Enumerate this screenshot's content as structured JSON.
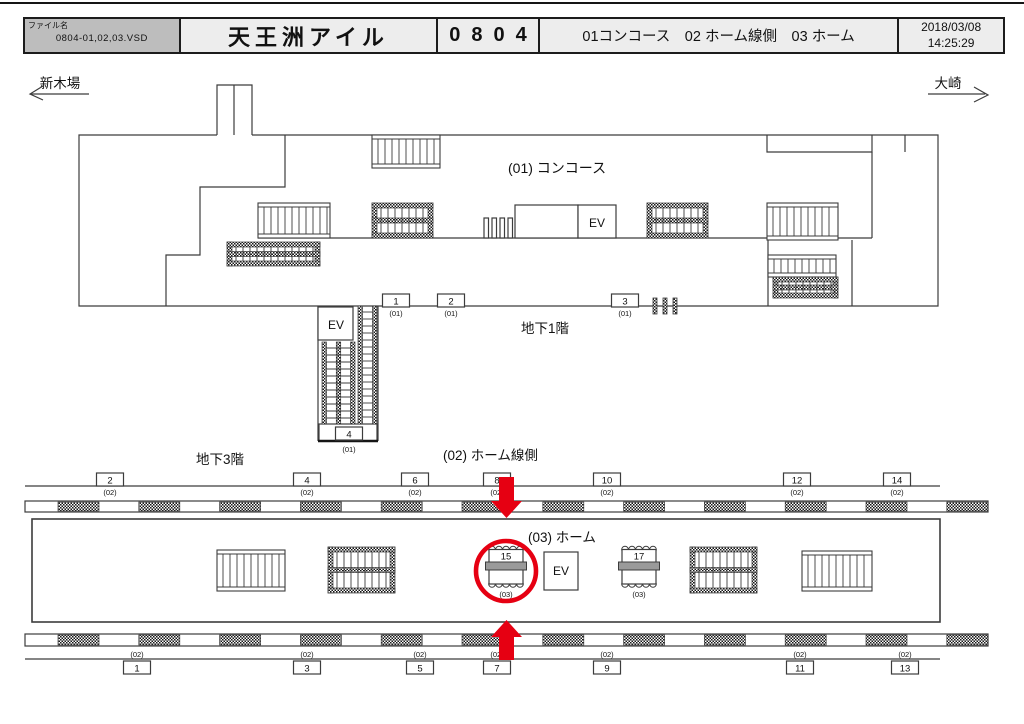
{
  "header": {
    "file_label": "ファイル名",
    "file_name": "0804-01,02,03.VSD",
    "station_name": "天王洲アイル",
    "station_code": "0804",
    "areas": "01コンコース　02 ホーム線側　03 ホーム",
    "date": "2018/03/08",
    "time": "14:25:29"
  },
  "direction": {
    "left": "新木場",
    "right": "大崎"
  },
  "labels": {
    "concourse": "(01) コンコース",
    "b1": "地下1階",
    "b3": "地下3階",
    "lineside": "(02) ホーム線側",
    "home": "(03) ホーム",
    "ev": "EV"
  },
  "positions": {
    "concourse": [
      {
        "no": "1",
        "level": "(01)"
      },
      {
        "no": "2",
        "level": "(01)"
      },
      {
        "no": "3",
        "level": "(01)"
      },
      {
        "no": "4",
        "level": "(01)"
      }
    ],
    "lineside_top": [
      {
        "no": "2",
        "level": "(02)"
      },
      {
        "no": "4",
        "level": "(02)"
      },
      {
        "no": "6",
        "level": "(02)"
      },
      {
        "no": "8",
        "level": "(02)"
      },
      {
        "no": "10",
        "level": "(02)"
      },
      {
        "no": "12",
        "level": "(02)"
      },
      {
        "no": "14",
        "level": "(02)"
      }
    ],
    "lineside_bottom": [
      {
        "no": "1",
        "level": "(02)"
      },
      {
        "no": "3",
        "level": "(02)"
      },
      {
        "no": "5",
        "level": "(02)"
      },
      {
        "no": "7",
        "level": "(02)"
      },
      {
        "no": "9",
        "level": "(02)"
      },
      {
        "no": "11",
        "level": "(02)"
      },
      {
        "no": "13",
        "level": "(02)"
      }
    ],
    "platform": [
      {
        "no": "15",
        "level": "(03)",
        "highlighted": true
      },
      {
        "no": "17",
        "level": "(03)",
        "highlighted": false
      }
    ]
  },
  "highlight": {
    "target": "15",
    "color": "#e60012"
  },
  "colors": {
    "line": "#3c3c3c",
    "header_bg": "#ededed",
    "file_cell_bg": "#bdbdbd",
    "highlight": "#e60012"
  }
}
